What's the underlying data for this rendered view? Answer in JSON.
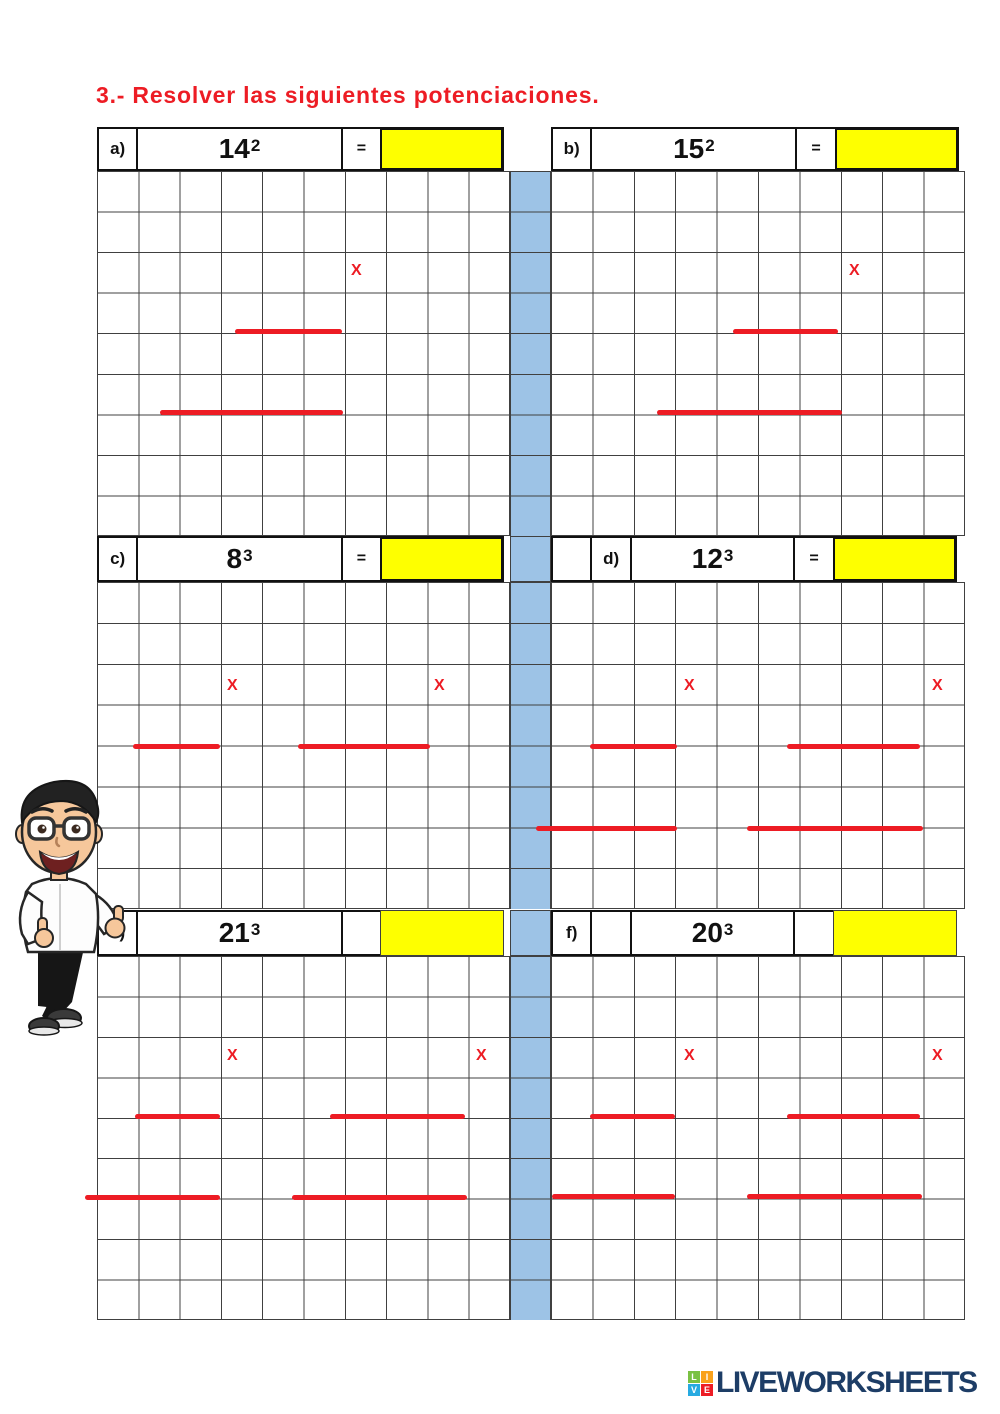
{
  "title": "3.- Resolver las siguientes potenciaciones.",
  "x_mark": "X",
  "problems": {
    "a": {
      "label": "a)",
      "base": "14",
      "exp": "2",
      "eq": "="
    },
    "b": {
      "label": "b)",
      "base": "15",
      "exp": "2",
      "eq": "="
    },
    "c": {
      "label": "c)",
      "base": "8",
      "exp": "3",
      "eq": "="
    },
    "d": {
      "label": "d)",
      "base": "12",
      "exp": "3",
      "eq": "="
    },
    "e": {
      "label": "e)",
      "base": "21",
      "exp": "3",
      "eq": ""
    },
    "f": {
      "label": "f)",
      "base": "20",
      "exp": "3",
      "eq": ""
    }
  },
  "colors": {
    "accent_red": "#ed1c24",
    "answer_yellow": "#feff00",
    "stripe_blue": "#9dc3e6",
    "grid_line": "#404040",
    "brand_navy": "#1d3d66",
    "logo_green": "#7ac143",
    "logo_orange": "#f9a11b",
    "logo_blue": "#27aae1",
    "logo_red": "#ed1c24"
  },
  "footer": {
    "brand": "LIVEWORKSHEETS",
    "icon_letters": {
      "tl": "L",
      "tr": "I",
      "bl": "V",
      "br": "E"
    }
  }
}
